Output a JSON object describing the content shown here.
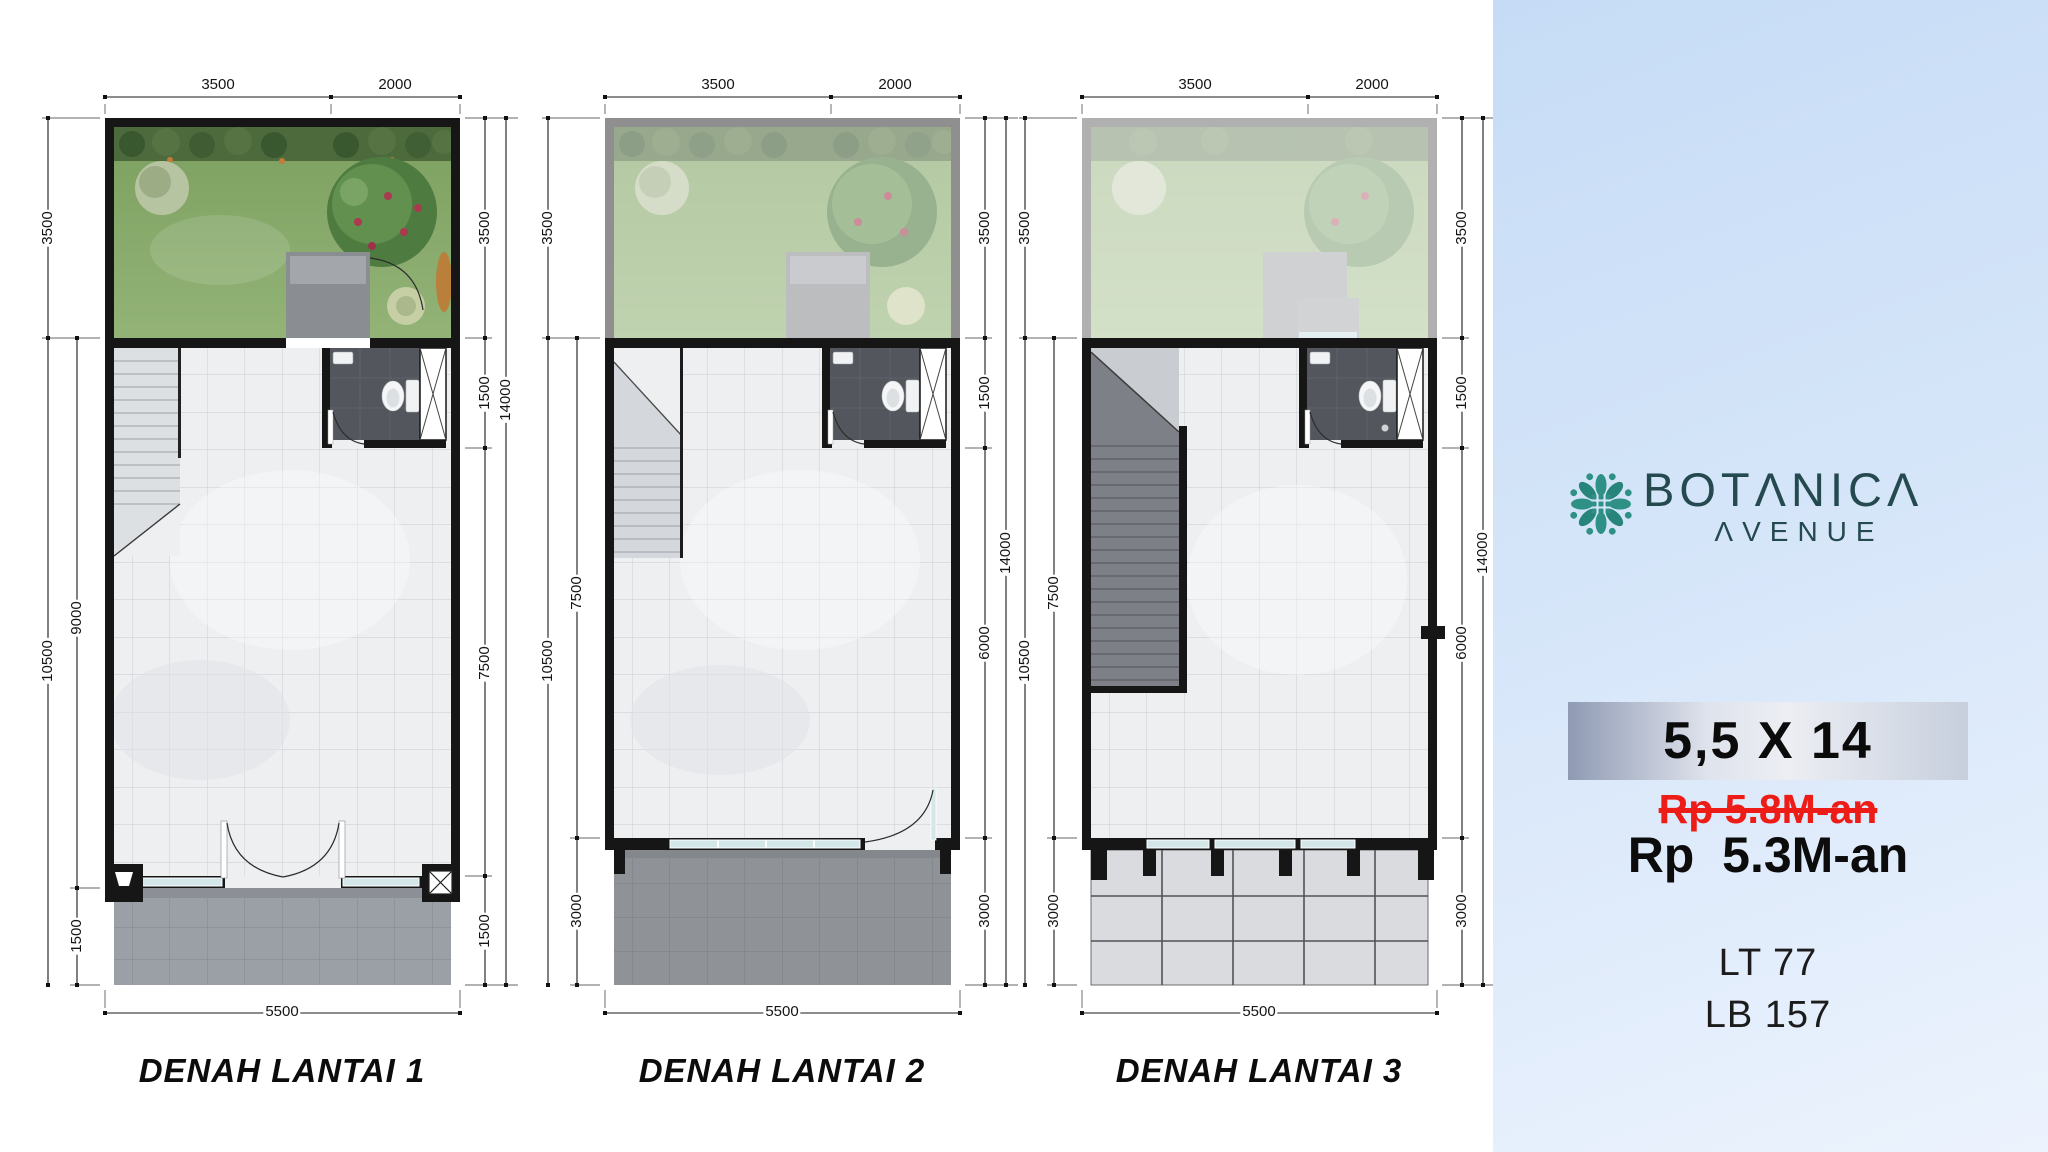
{
  "brand": {
    "name": "BOTANICA",
    "subtitle": "AVENUE",
    "logo_icon": "flower-rosette-icon",
    "logo_color": "#2f9186",
    "text_color": "#24494f"
  },
  "offer": {
    "size_label": "5,5 X 14",
    "old_price": "Rp 5.8M-an",
    "new_price": "Rp  5.3M-an",
    "land_area": "LT 77",
    "building_area": "LB 157",
    "old_price_color": "#ee1c16"
  },
  "plans": [
    {
      "label": "DENAH LANTAI 1",
      "dims": {
        "top_width_left": "3500",
        "top_width_right": "2000",
        "left_garden": "3500",
        "left_total": "10500",
        "left_main": "9000",
        "left_front": "1500",
        "right_garden": "3500",
        "right_bath": "1500",
        "right_main": "7500",
        "right_front": "1500",
        "right_total": "14000",
        "bottom_width": "5500"
      }
    },
    {
      "label": "DENAH LANTAI 2",
      "dims": {
        "top_width_left": "3500",
        "top_width_right": "2000",
        "left_garden": "3500",
        "left_total": "10500",
        "left_main": "7500",
        "left_front": "3000",
        "right_garden": "3500",
        "right_bath": "1500",
        "right_main": "6000",
        "right_front": "3000",
        "right_total": "14000",
        "bottom_width": "5500"
      }
    },
    {
      "label": "DENAH LANTAI 3",
      "dims": {
        "top_width_left": "3500",
        "top_width_right": "2000",
        "left_garden": "3500",
        "left_total": "10500",
        "left_main": "7500",
        "left_front": "3000",
        "right_garden": "3500",
        "right_bath": "1500",
        "right_main": "6000",
        "right_front": "3000",
        "right_total": "14000",
        "bottom_width": "5500"
      }
    }
  ]
}
